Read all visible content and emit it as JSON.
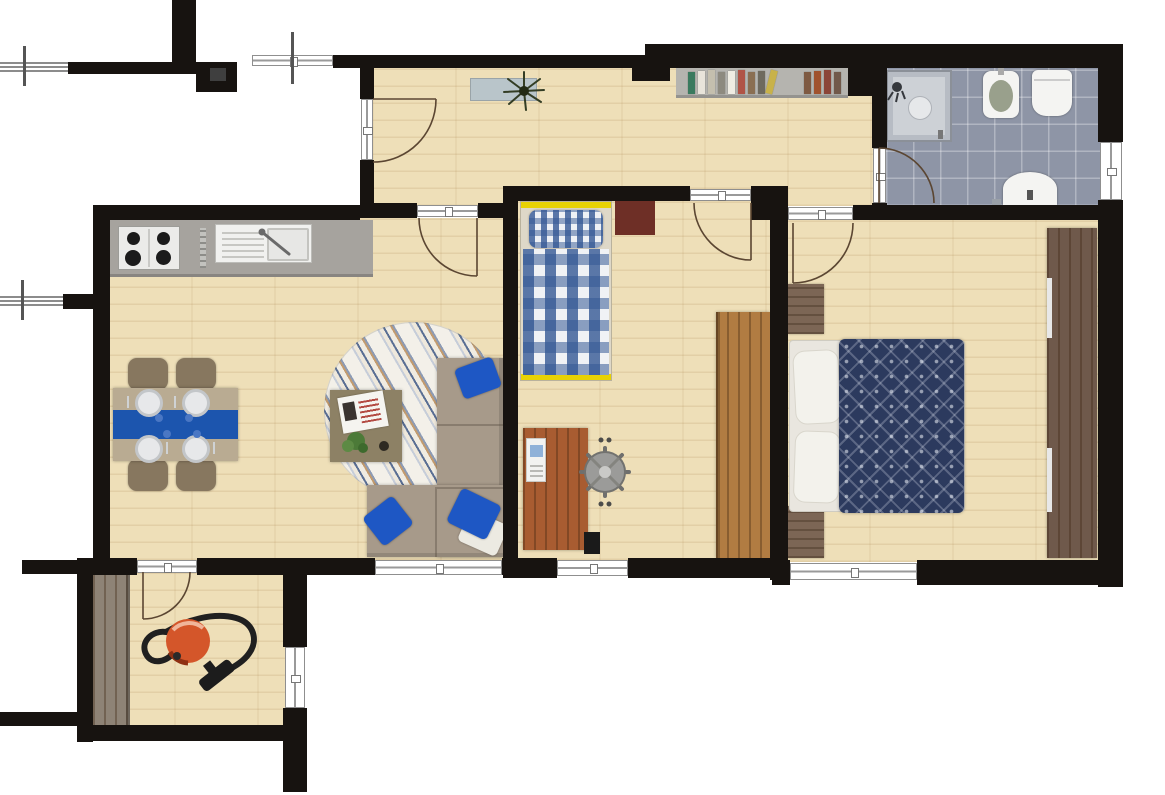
{
  "meta": {
    "kind": "apartment-floor-plan-top-view",
    "canvas": {
      "width": 1165,
      "height": 795
    }
  },
  "colors": {
    "wall": "#171310",
    "wood": "#eedfb8",
    "tile": "#8e95a6",
    "counter": "#a6a39e",
    "stove": "#ebebe9",
    "burner": "#1b1b1b",
    "sink": "#f1f1ef",
    "table": "#b9ab92",
    "runner": "#1c55ae",
    "chair": "#87775f",
    "sofa": "#a79a8a",
    "pillow": "#1e57c4",
    "pillow-white": "#eceae2",
    "coffee-table": "#8d8165",
    "bed-frame": "#ded8c8",
    "bed-yellow": "#e8d204",
    "duvet": "#2c3a5e",
    "mattress": "#e9e6df",
    "nightstand": "#7c6655",
    "wardrobe-master": "#6f594b",
    "wardrobe-kid": "#b17c42",
    "wardrobe-entry": "#8e8376",
    "desk": "#a85c31",
    "chair-gray": "#9b9b99",
    "vacuum": "#d4562a",
    "hose": "#202020",
    "arc": "#5b4632",
    "shower-frame": "#b7bcc4",
    "shower-inner": "#cdd1d6",
    "fixture": "#f4f4f2",
    "bidet-inner": "#99a08c",
    "bookshelf": "#b5b4af",
    "console": "#b9c5ca",
    "kid-mat": "#6e2f26"
  },
  "bookshelf": {
    "books_left": [
      "#3a7a5e",
      "#e8e4da",
      "#c4bfae",
      "#8d8a7f",
      "#efece2",
      "#b05446",
      "#8a6f52",
      "#6e6a5e",
      "#c8b24a"
    ],
    "books_right": [
      "#7e5a42",
      "#a0522d",
      "#8b4538",
      "#71594a"
    ]
  },
  "rooms": [
    {
      "name": "hallway",
      "items": [
        "entrance-door",
        "console-table",
        "potted-plant",
        "bookshelf"
      ]
    },
    {
      "name": "bathroom",
      "items": [
        "shower",
        "bidet",
        "toilet",
        "washbasin",
        "door",
        "window"
      ]
    },
    {
      "name": "kitchen-living-room",
      "items": [
        "cooktop-4-burners",
        "kitchen-sink",
        "counter",
        "dining-table-blue-runner",
        "4-chairs",
        "4-place-settings",
        "round-rug",
        "coffee-table",
        "corner-sofa",
        "blue-cushions",
        "window"
      ]
    },
    {
      "name": "kids-bedroom",
      "items": [
        "single-bed-plaid",
        "bedside-mat",
        "desk",
        "desk-chair",
        "tall-wardrobe",
        "window",
        "door"
      ]
    },
    {
      "name": "master-bedroom",
      "items": [
        "double-bed",
        "2-white-pillows",
        "navy-patterned-duvet",
        "2-nightstands",
        "sliding-wardrobe",
        "window",
        "door"
      ]
    },
    {
      "name": "entry-room",
      "items": [
        "coat-closet",
        "vacuum-cleaner",
        "interior-door",
        "side-door"
      ]
    }
  ]
}
